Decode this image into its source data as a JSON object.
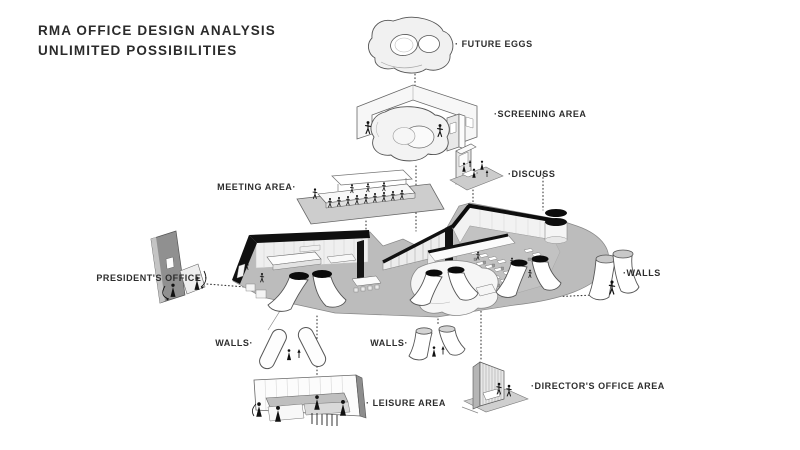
{
  "title": {
    "line1": "RMA OFFICE DESIGN ANALYSIS",
    "line2": "UNLIMITED POSSIBILITIES"
  },
  "callouts": [
    {
      "id": "future-eggs",
      "label": "· FUTURE EGGS"
    },
    {
      "id": "screening-area",
      "label": "·SCREENING AREA"
    },
    {
      "id": "discuss",
      "label": "·DISCUSS"
    },
    {
      "id": "meeting-area",
      "label": "MEETING AREA·"
    },
    {
      "id": "presidents-office",
      "label": "PRESIDENT'S OFFICE ·"
    },
    {
      "id": "walls-right",
      "label": "·WALLS"
    },
    {
      "id": "walls-left",
      "label": "WALLS·"
    },
    {
      "id": "walls-center",
      "label": "WALLS·"
    },
    {
      "id": "leisure-area",
      "label": "· LEISURE AREA"
    },
    {
      "id": "directors-office-area",
      "label": "·DIRECTOR'S OFFICE AREA"
    }
  ],
  "colors": {
    "background": "#ffffff",
    "ink": "#2d2d2d",
    "sketch_line": "#555555",
    "floor_gray": "#bcbcbc",
    "black_wall": "#111111",
    "panel_gray": "#909090"
  }
}
